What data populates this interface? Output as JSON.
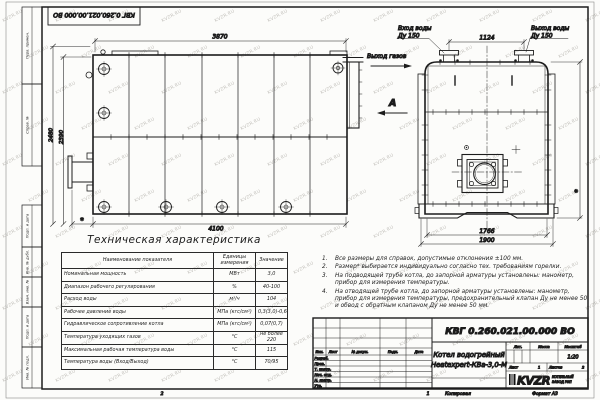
{
  "frame": {
    "doc_number_top": "КВГ 0.260.021.00.000 ВО",
    "margin_labels": [
      "Перв. примен.",
      "Справ. №",
      "Подп. и дата",
      "Инв. № дубл.",
      "Взам. инв. №",
      "Подп. и дата",
      "Инв. № подл."
    ],
    "footer": {
      "zone_left": "2",
      "zone_num": "1",
      "copied": "Копировал",
      "format": "Формат А3"
    }
  },
  "watermark": {
    "text": "KVZR.RU",
    "color": "#c3c1bc"
  },
  "views": {
    "side_view": {
      "dims": {
        "top": "3870",
        "left_outer": "2480",
        "left_inner": "2390",
        "bottom": "4100",
        "bottom_star": "*"
      }
    },
    "front_view": {
      "labels": {
        "water_in_1": "Вход воды",
        "water_in_2": "Ду 150",
        "water_out_1": "Выход воды",
        "water_out_2": "Ду 150",
        "gas_out": "Выход газов",
        "view_arrow": "А"
      },
      "dims": {
        "top": "1124",
        "bottom_inner": "1766",
        "bottom_outer": "1900",
        "right_star": "*"
      }
    }
  },
  "table": {
    "title": "Техническая характеристика",
    "headers": [
      "Наименование показателя",
      "Единицы измерения",
      "Значение"
    ],
    "rows": [
      [
        "Номинальная мощность",
        "МВт",
        "3,0"
      ],
      [
        "Диапазон рабочего регулирования",
        "%",
        "40-100"
      ],
      [
        "Расход воды",
        "м³/ч",
        "104"
      ],
      [
        "Рабочее давление воды",
        "МПа (кгс/см²)",
        "0,3(3,0)-0,6(6,0)"
      ],
      [
        "Гидравлическое сопротивление котла",
        "МПа (кгс/см²)",
        "0,07(0,7)"
      ],
      [
        "Температура уходящих газов",
        "°С",
        "не более 220"
      ],
      [
        "Максимальная рабочая температура воды",
        "°С",
        "115"
      ],
      [
        "Температура воды (Вход/Выход)",
        "°С",
        "70/95"
      ]
    ]
  },
  "notes": [
    "Все размеры для справок, допустимые отклонения ±100 мм.",
    "Размер* выбирается индивидуально согласно тех. требованиям горелки.",
    "На подводящей трубе котла, до запорной арматуры установлены: манометр, прибор для измерения температуры.",
    "На отводящей трубе котла, до запорной арматуры установлены: манометр, прибор для измерения температуры, предохранительный клапан Ду не менее 50 и обвод с обратным клапаном Ду не менее 50 мм."
  ],
  "title_block": {
    "doc_number": "КВГ 0.260.021.00.000 ВО",
    "product_name_1": "Котел водогрейный",
    "product_name_2": "Heatexpert-КВа-3,0-М",
    "header_cols": [
      "Изм.",
      "Лист",
      "№ докум.",
      "Подп.",
      "Дата"
    ],
    "row_labels": [
      "Разраб.",
      "Пров.",
      "Т. контр.",
      "Нач. отд.",
      "Н. контр.",
      "Утв."
    ],
    "lit_label": "Лит.",
    "mass_label": "Масса",
    "scale_label": "Масштаб",
    "scale_value": "1:20",
    "sheet_label": "Лист",
    "sheet_value": "1",
    "sheets_label": "Листов",
    "sheets_value": "2",
    "logo_text": "KVZR",
    "logo_sub1": "КОТЕЛЬНЫЙ",
    "logo_sub2": "ЗАВОД РЭП"
  }
}
